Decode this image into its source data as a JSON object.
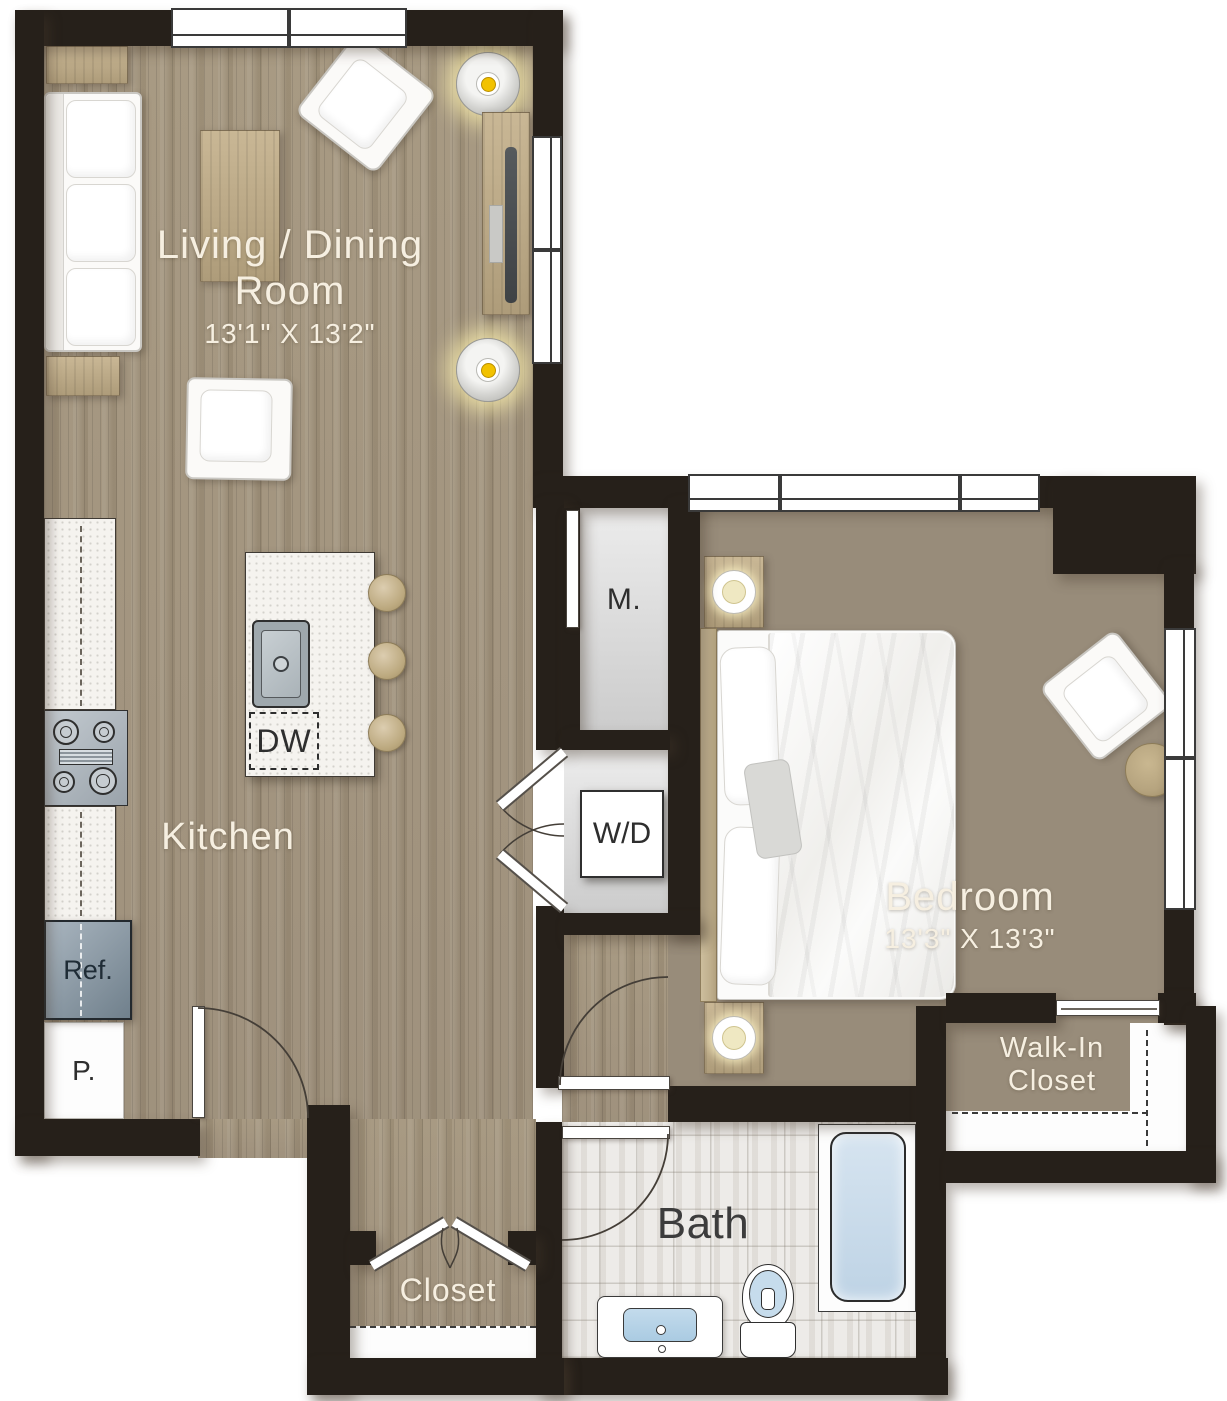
{
  "title": "One-bedroom apartment floor plan",
  "labels": {
    "living_room_line1": "Living / Dining",
    "living_room_line2": "Room",
    "living_room_dims": "13'1\" X 13'2\"",
    "kitchen": "Kitchen",
    "bedroom": "Bedroom",
    "bedroom_dims": "13'3\" X 13'3\"",
    "bath": "Bath",
    "closet": "Closet",
    "walk_in_line1": "Walk-In",
    "walk_in_line2": "Closet",
    "mech_closet": "M.",
    "washer_dryer": "W/D",
    "dishwasher": "DW",
    "refrigerator": "Ref.",
    "pantry": "P."
  },
  "colors": {
    "wall": "#26201a",
    "wood_living": "#a3957f",
    "wood_bedroom": "#988c7a",
    "bath_tile": "#edebe8",
    "closet_floor": "#e0e0e0",
    "label_light": "#f6efe1",
    "label_dark": "#2e2e2e",
    "light_accent": "#f2c200",
    "tub_fill": "#c9dcec",
    "sink_fill": "#b5d4e8"
  }
}
